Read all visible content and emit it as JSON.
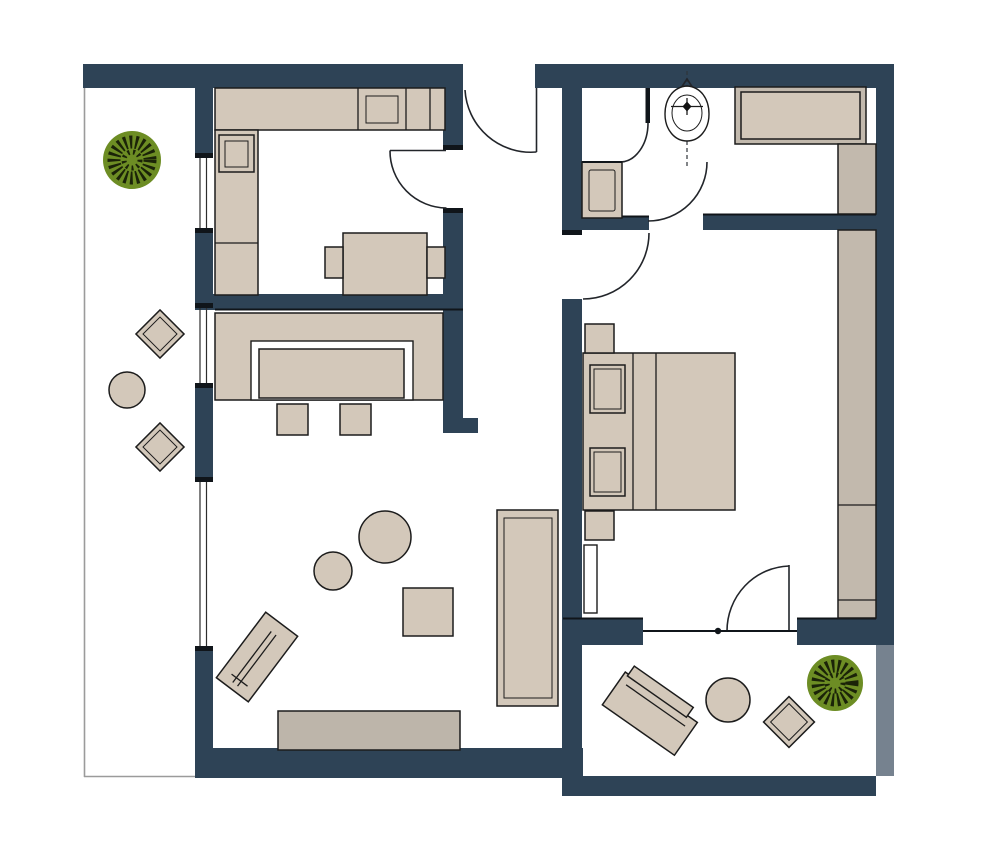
{
  "title": "apartment-floor-plan",
  "description": "Top-down architectural floor plan of a one-bedroom apartment with kitchen, living room, bedroom, bathroom, hallway, side balcony and lower terrace. No text labels are rendered in the drawing.",
  "colors": {
    "background": "#ffffff",
    "wall": "#2e4356",
    "furniture": "#d3c8ba",
    "cabinet": "#c2b9ad",
    "sideboard": "#bdb5aa",
    "railing": "#76828f",
    "plant_pot": "#6d8d24",
    "plant_leaves": "#1b2308",
    "outline": "#1c1c1c",
    "boundary": "#9b9b9b"
  },
  "rooms": [
    {
      "name": "kitchen",
      "position": "top-left",
      "furniture": [
        "kitchen-counter",
        "sink",
        "stove",
        "tall-cabinet-column",
        "dining-table",
        "dining-chair-left",
        "dining-chair-right"
      ]
    },
    {
      "name": "hallway",
      "position": "top-center",
      "furniture": []
    },
    {
      "name": "bathroom",
      "position": "top-right",
      "furniture": [
        "toilet",
        "bathtub",
        "washing-machine",
        "bathroom-cabinet",
        "partition-screen"
      ]
    },
    {
      "name": "living-room",
      "position": "center-left",
      "furniture": [
        "corner-sofa",
        "coffee-table",
        "stool-1",
        "stool-2",
        "daybed",
        "pouf-large",
        "pouf-small",
        "floor-cushion",
        "lounge-chair",
        "sideboard"
      ]
    },
    {
      "name": "bedroom",
      "position": "center-right",
      "furniture": [
        "double-bed",
        "pillow-1",
        "pillow-2",
        "nightstand-top",
        "nightstand-bottom",
        "wardrobe",
        "radiator"
      ]
    },
    {
      "name": "balcony",
      "position": "left-strip",
      "furniture": [
        "potted-plant",
        "balcony-chair-1",
        "balcony-chair-2",
        "balcony-side-table"
      ]
    },
    {
      "name": "terrace",
      "position": "bottom-right",
      "furniture": [
        "sun-lounger",
        "terrace-round-table",
        "terrace-chair",
        "potted-plant"
      ]
    }
  ],
  "openings": {
    "entrance_door": "top wall, swings into hallway",
    "kitchen_door": "hallway to kitchen, swings into kitchen",
    "bathroom_door": "hallway to bathroom, swings into bathroom",
    "wc_partition_door": "small swing beside washing machine niche",
    "bedroom_door": "hallway to bedroom, swings into bedroom",
    "terrace_door": "bedroom to terrace, swings into bedroom",
    "windows": [
      "kitchen-window",
      "living-room-window",
      "balcony-door-window"
    ]
  },
  "counts": {
    "plants": 2,
    "doors": 6,
    "rooms": 7
  }
}
